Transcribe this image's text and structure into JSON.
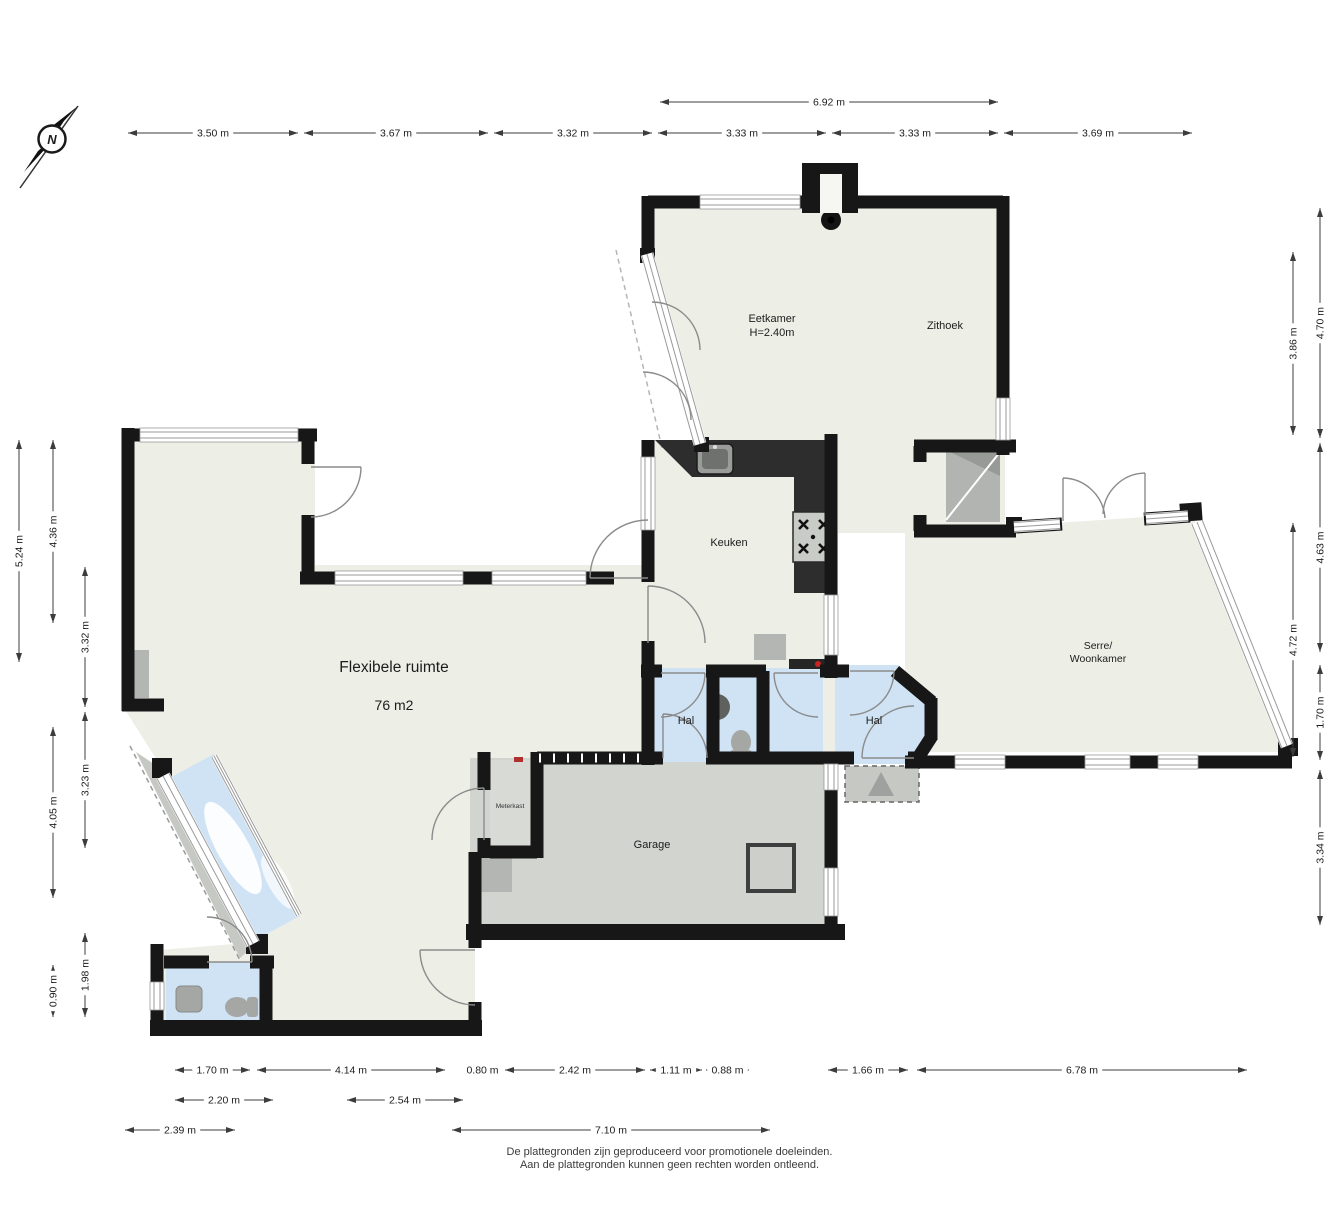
{
  "compass": {
    "label": "N"
  },
  "rooms": {
    "eetkamer": {
      "name": "Eetkamer",
      "height_note": "H=2.40m"
    },
    "zithoek": {
      "name": "Zithoek"
    },
    "keuken": {
      "name": "Keuken"
    },
    "flexibele_ruimte": {
      "name": "Flexibele ruimte",
      "area": "76 m2"
    },
    "hal_left": {
      "name": "Hal"
    },
    "hal_right": {
      "name": "Hal"
    },
    "garage": {
      "name": "Garage"
    },
    "meterkast": {
      "name": "Meterkast"
    },
    "serre": {
      "line1": "Serre/",
      "line2": "Woonkamer"
    }
  },
  "footer": {
    "line1": "De plattegronden zijn geproduceerd voor promotionele doeleinden.",
    "line2": "Aan de plattegronden kunnen geen rechten worden ontleend."
  },
  "colors": {
    "wall": "#171717",
    "floor": "#edeee6",
    "hall_blue": "#cfe3f4",
    "garage_gray": "#d2d4d0",
    "outside_gray": "#c6c8c4"
  },
  "dimensions": {
    "horizontal": [
      {
        "label": "3.50 m",
        "x1": 128,
        "x2": 298,
        "y": 133
      },
      {
        "label": "3.67 m",
        "x1": 304,
        "x2": 488,
        "y": 133
      },
      {
        "label": "3.32 m",
        "x1": 494,
        "x2": 652,
        "y": 133
      },
      {
        "label": "3.33 m",
        "x1": 658,
        "x2": 826,
        "y": 133
      },
      {
        "label": "3.33 m",
        "x1": 832,
        "x2": 998,
        "y": 133
      },
      {
        "label": "3.69 m",
        "x1": 1004,
        "x2": 1192,
        "y": 133
      },
      {
        "label": "6.92 m",
        "x1": 660,
        "x2": 998,
        "y": 102
      },
      {
        "label": "1.70 m",
        "x1": 175,
        "x2": 250,
        "y": 1070
      },
      {
        "label": "4.14 m",
        "x1": 257,
        "x2": 445,
        "y": 1070
      },
      {
        "label": "0.80 m",
        "x1": 465,
        "x2": 500,
        "y": 1070
      },
      {
        "label": "2.42 m",
        "x1": 505,
        "x2": 645,
        "y": 1070
      },
      {
        "label": "1.11 m",
        "x1": 650,
        "x2": 702,
        "y": 1070
      },
      {
        "label": "0.88 m",
        "x1": 706,
        "x2": 749,
        "y": 1070
      },
      {
        "label": "1.66 m",
        "x1": 828,
        "x2": 908,
        "y": 1070
      },
      {
        "label": "6.78 m",
        "x1": 917,
        "x2": 1247,
        "y": 1070
      },
      {
        "label": "2.20 m",
        "x1": 175,
        "x2": 273,
        "y": 1100
      },
      {
        "label": "2.54 m",
        "x1": 347,
        "x2": 463,
        "y": 1100
      },
      {
        "label": "2.39 m",
        "x1": 125,
        "x2": 235,
        "y": 1130
      },
      {
        "label": "7.10 m",
        "x1": 452,
        "x2": 770,
        "y": 1130
      }
    ],
    "vertical": [
      {
        "label": "5.24 m",
        "y1": 440,
        "y2": 662,
        "x": 19
      },
      {
        "label": "4.36 m",
        "y1": 440,
        "y2": 623,
        "x": 53
      },
      {
        "label": "3.32 m",
        "y1": 567,
        "y2": 707,
        "x": 85
      },
      {
        "label": "3.23 m",
        "y1": 712,
        "y2": 848,
        "x": 85
      },
      {
        "label": "4.05 m",
        "y1": 727,
        "y2": 898,
        "x": 53
      },
      {
        "label": "1.98 m",
        "y1": 933,
        "y2": 1017,
        "x": 85
      },
      {
        "label": "0.90 m",
        "y1": 965,
        "y2": 1017,
        "x": 53
      },
      {
        "label": "3.86 m",
        "y1": 252,
        "y2": 435,
        "x": 1293
      },
      {
        "label": "4.70 m",
        "y1": 208,
        "y2": 438,
        "x": 1320
      },
      {
        "label": "4.63 m",
        "y1": 443,
        "y2": 652,
        "x": 1320
      },
      {
        "label": "4.72 m",
        "y1": 523,
        "y2": 757,
        "x": 1293
      },
      {
        "label": "1.70 m",
        "y1": 665,
        "y2": 760,
        "x": 1320
      },
      {
        "label": "3.34 m",
        "y1": 770,
        "y2": 925,
        "x": 1320
      }
    ]
  }
}
